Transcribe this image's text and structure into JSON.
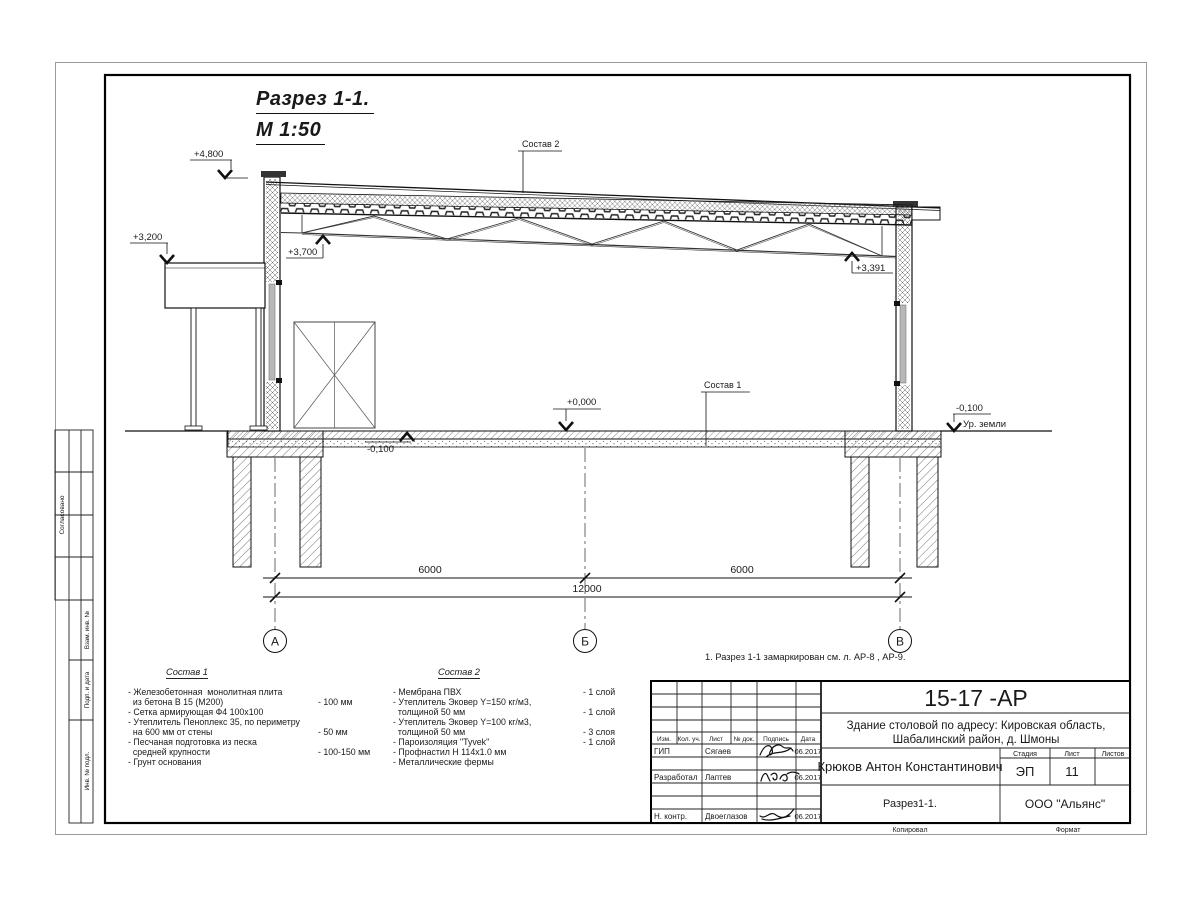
{
  "drawing": {
    "title": "Разрез 1-1.",
    "scale": "М 1:50",
    "note": "1. Разрез 1-1 замаркирован см. л. АР-8 , АР-9.",
    "elevations": {
      "top": "+4,800",
      "canopy": "+3,200",
      "truss_left": "+3,700",
      "truss_right": "+3,391",
      "floor": "+0,000",
      "floor_minus": "-0,100",
      "ground_minus": "-0,100",
      "ground_label": "Ур. земли"
    },
    "callouts": {
      "sostav1": "Состав 1",
      "sostav2": "Состав 2"
    },
    "dims": {
      "span1": "6000",
      "span2": "6000",
      "total": "12000"
    },
    "axes": {
      "a": "А",
      "b": "Б",
      "v": "В"
    }
  },
  "materials": {
    "list1": {
      "title": "Состав 1",
      "rows": [
        {
          "t": "- Железобетонная  монолитная плита",
          "q": ""
        },
        {
          "t": "  из бетона В 15 (М200)",
          "q": "- 100 мм"
        },
        {
          "t": "- Сетка армирующая Ф4 100х100",
          "q": ""
        },
        {
          "t": "- Утеплитель Пеноплекс 35, по периметру",
          "q": ""
        },
        {
          "t": "  на 600 мм от стены",
          "q": "- 50 мм"
        },
        {
          "t": "- Песчаная подготовка из песка",
          "q": ""
        },
        {
          "t": "  средней крупности",
          "q": "- 100-150 мм"
        },
        {
          "t": "- Грунт основания",
          "q": ""
        }
      ]
    },
    "list2": {
      "title": "Состав 2",
      "rows": [
        {
          "t": "- Мембрана ПВХ",
          "q": "- 1 слой"
        },
        {
          "t": "- Утеплитель Эковер Y=150 кг/м3,",
          "q": ""
        },
        {
          "t": "  толщиной 50 мм",
          "q": "- 1 слой"
        },
        {
          "t": "- Утеплитель Эковер Y=100 кг/м3,",
          "q": ""
        },
        {
          "t": "  толщиной 50 мм",
          "q": "- 3 слоя"
        },
        {
          "t": "- Пароизоляция \"Tyvek\"",
          "q": "- 1 слой"
        },
        {
          "t": "- Профнастил Н 114х1.0 мм",
          "q": ""
        },
        {
          "t": "- Металлические фермы",
          "q": ""
        }
      ]
    }
  },
  "titleblock": {
    "doc_number": "15-17 -АР",
    "object_line1": "Здание столовой по адресу: Кировская область,",
    "object_line2": "Шабалинский район, д. Шмоны",
    "author": "Крюков Антон Константинович",
    "sheet_title": "Разрез1-1.",
    "company": "ООО \"Альянс\"",
    "stage_label": "Стадия",
    "sheet_label": "Лист",
    "sheets_label": "Листов",
    "stage": "ЭП",
    "sheet": "11",
    "sheets": "",
    "col_headers": [
      "Изм.",
      "Кол. уч.",
      "Лист",
      "№ док.",
      "Подпись",
      "Дата"
    ],
    "rows": [
      {
        "role": "ГИП",
        "name": "Сягаев",
        "date": "06.2017"
      },
      {
        "role": "",
        "name": "",
        "date": ""
      },
      {
        "role": "Разработал",
        "name": "Лаптев",
        "date": "06.2017"
      },
      {
        "role": "",
        "name": "",
        "date": ""
      },
      {
        "role": "",
        "name": "",
        "date": ""
      },
      {
        "role": "Н. контр.",
        "name": "Двоеглазов",
        "date": "06.2017"
      }
    ],
    "footer_left": "Копировал",
    "footer_right": "Формат"
  },
  "side_stamp": {
    "approved": "Согласовано",
    "vzam": "Взам. инв. №",
    "podp": "Подп. и дата",
    "inv": "Инв. № подл."
  }
}
